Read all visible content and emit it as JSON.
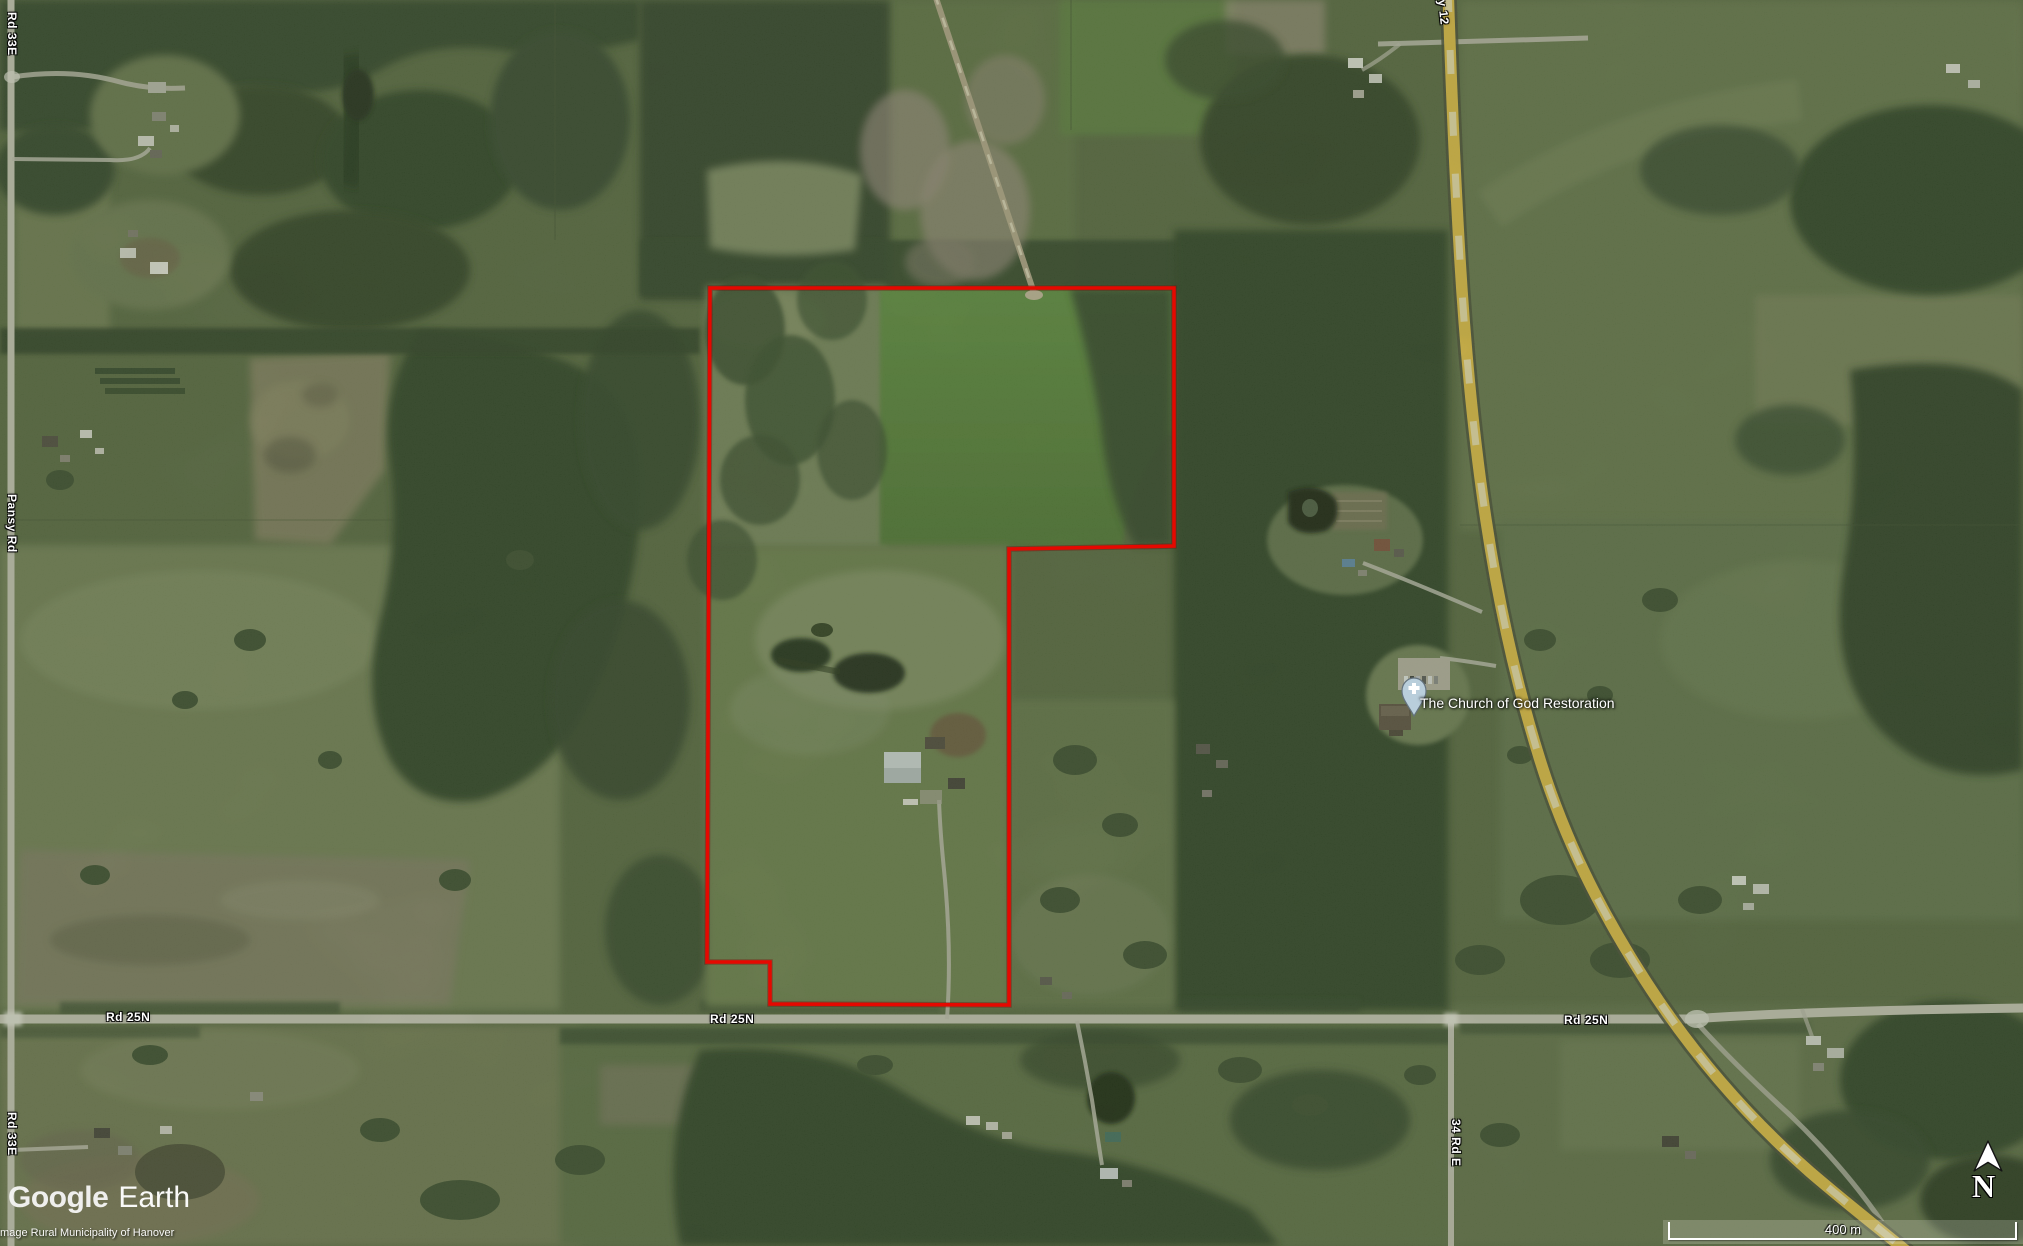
{
  "map": {
    "road_labels": [
      {
        "id": "rd33e_top",
        "text": "Rd 33E"
      },
      {
        "id": "pansy_rd",
        "text": "Pansy Rd"
      },
      {
        "id": "rd33e_bottom",
        "text": "Rd 33E"
      },
      {
        "id": "rd25n_left",
        "text": "Rd 25N"
      },
      {
        "id": "rd25n_center",
        "text": "Rd 25N"
      },
      {
        "id": "rd25n_right",
        "text": "Rd 25N"
      },
      {
        "id": "rd34e",
        "text": "34 Rd E"
      },
      {
        "id": "hwy12",
        "text": "Hwy 12"
      }
    ],
    "poi": {
      "church_label": "The Church of God Restoration"
    },
    "overlay": {
      "logo_google": "Google",
      "logo_earth": "Earth",
      "attribution": "Image Rural Municipality of Hanover",
      "scale_label": "400 m",
      "north_label": "N"
    },
    "colors": {
      "boundary_red": "#e60800",
      "highway_yellow": "#e2bc41",
      "label_white": "#ffffff"
    }
  }
}
